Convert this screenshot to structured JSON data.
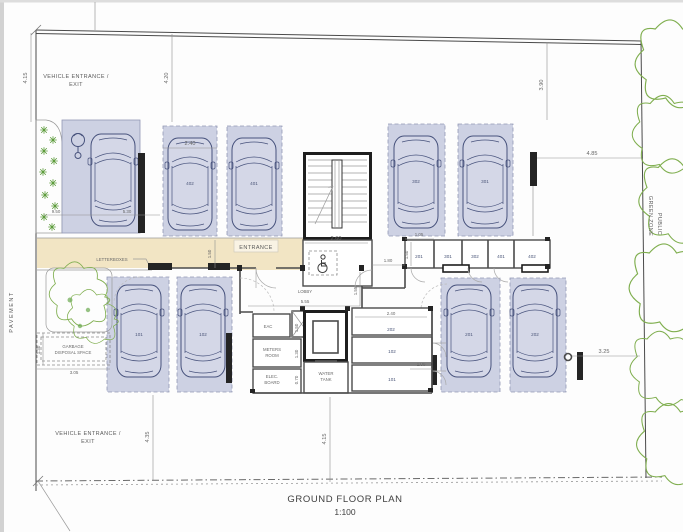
{
  "plan": {
    "title": "GROUND FLOOR PLAN",
    "scale": "1:100"
  },
  "site_labels": {
    "vehicle_entrance_top": "VEHICLE ENTRANCE /",
    "vehicle_exit_top": "EXIT",
    "vehicle_entrance_bottom": "VEHICLE ENTRANCE /",
    "vehicle_exit_bottom": "EXIT",
    "pavement": "PAVEMENT",
    "public_green_zone_line1": "PUBLIC",
    "public_green_zone_line2": "GREEN ZONE"
  },
  "building_labels": {
    "entrance": "ENTRANCE",
    "lobby": "LOBBY",
    "letterboxes": "LETTERBOXES",
    "garbage_line1": "GARBAGE",
    "garbage_line2": "DISPOSAL SPACE",
    "eac": "EAC",
    "meters_room_line1": "METERS",
    "meters_room_line2": "ROOM",
    "elec_line1": "ELEC.",
    "elec_line2": "BOARD",
    "water_tank_line1": "WATER",
    "water_tank_line2": "TANK"
  },
  "parking_stalls": {
    "top_row": [
      "402",
      "401",
      "302",
      "301"
    ],
    "bottom_row": [
      "101",
      "102",
      "201",
      "202"
    ]
  },
  "storage_rooms": {
    "right_row": [
      "201",
      "301",
      "302",
      "401",
      "402"
    ],
    "center_stack": [
      "202",
      "102",
      "101"
    ]
  },
  "dimensions": {
    "site_left": "4.15",
    "site_mid": "4.20",
    "site_right": "3.90",
    "stall_width": "2.40",
    "east_setback": "4.85",
    "aisle_a": "9.50",
    "aisle_b": "5.30",
    "stair_width": "2.60",
    "corridor": "1.80",
    "walk": "1.50",
    "storage_width": "1.05",
    "storage_depth": "1.50",
    "lobby_width": "5.55",
    "lobby_depth": "1.55",
    "storage_center_width": "2.40",
    "door": "1.00",
    "east_gap": "3.25",
    "garbage_width": "3.05",
    "garbage_depth": "1.30",
    "drive_left": "4.35",
    "drive_mid": "4.15",
    "eac_depth": "1.50",
    "meters_depth": "1.30",
    "elec_depth": "0.70"
  },
  "colors": {
    "stall_fill": "#cdd1e3",
    "walkway_fill": "#f2e5c4",
    "green": "#7fae4e"
  }
}
